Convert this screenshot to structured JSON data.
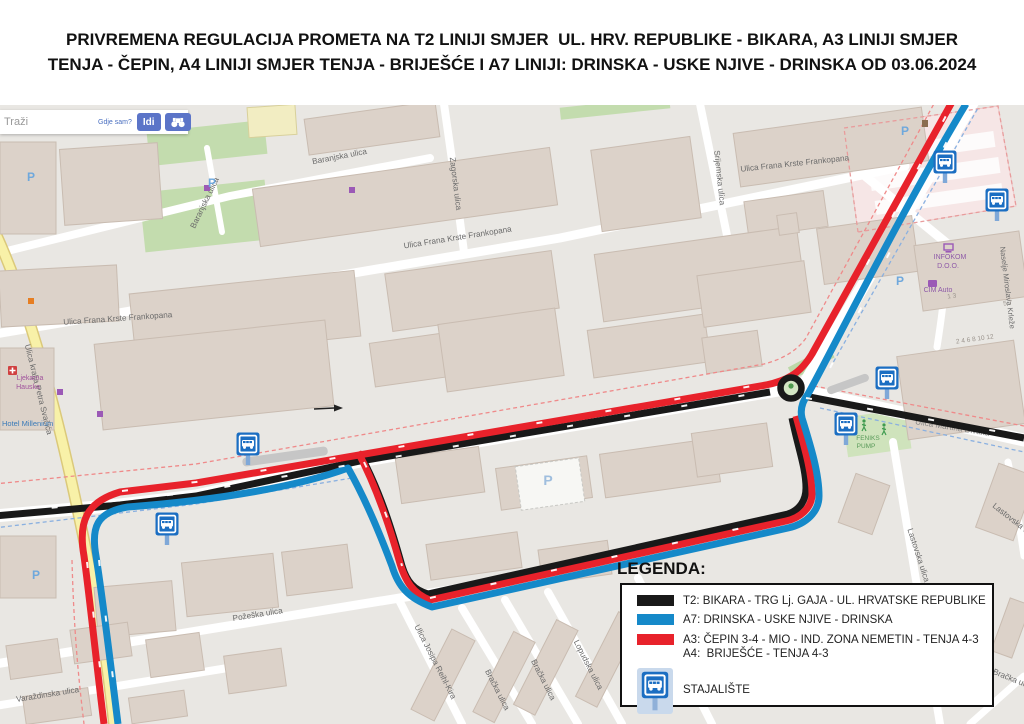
{
  "title": {
    "line1": "PRIVREMENA REGULACIJA PROMETA NA T2 LINIJI SMJER  UL. HRV. REPUBLIKE - BIKARA, A3 LINIJI SMJER",
    "line2": "TENJA - ČEPIN, A4 LINIJI SMJER TENJA - BRIJEŠĆE I A7 LINIJI: DRINSKA - USKE NJIVE - DRINSKA OD 03.06.2024"
  },
  "search": {
    "placeholder": "Traži",
    "where_am_i": "Gdje sam?",
    "go": "Idi"
  },
  "legend": {
    "heading": "LEGENDA:",
    "t2": {
      "color": "#191919",
      "label": "T2: BIKARA - TRG Lj. GAJA - UL. HRVATSKE REPUBLIKE"
    },
    "a7": {
      "color": "#1589c9",
      "label": "A7: DRINSKA - USKE NJIVE - DRINSKA"
    },
    "a3": {
      "color": "#e8222b",
      "label": "A3: ČEPIN 3-4 - MIO - IND. ZONA NEMETIN - TENJA 4-3"
    },
    "a4": {
      "label": "A4:  BRIJEŠĆE - TENJA 4-3"
    },
    "stop_label": "STAJALIŠTE"
  },
  "map": {
    "colors": {
      "route_red": "#e8222b",
      "route_blue": "#1589c9",
      "route_black": "#191919",
      "bus_sign_blue": "#1b6ec2"
    },
    "parking_letter": "P",
    "streets": [
      {
        "t": "Baranjska ulica"
      },
      {
        "t": "Baranjska ulica"
      },
      {
        "t": "Zagorska ulica"
      },
      {
        "t": "Srijemska ulica"
      },
      {
        "t": "Ulica Frana Krste Frankopana"
      },
      {
        "t": "Ulica Frana Krste Frankopana"
      },
      {
        "t": "Ulica Frana Krste Frankopana"
      },
      {
        "t": "Ulica kralja Petra Svačića"
      },
      {
        "t": "Požeška ulica"
      },
      {
        "t": "Varaždinska ulica"
      },
      {
        "t": "Ulica Josipa Reihl-Kira"
      },
      {
        "t": "Bračka ulica"
      },
      {
        "t": "Bračka ulica"
      },
      {
        "t": "Lopudska ulica"
      },
      {
        "t": "Lastovska ulica"
      },
      {
        "t": "Lastovska ulica"
      },
      {
        "t": "Bračka ulica"
      },
      {
        "t": "Ulica Martina Divalta"
      },
      {
        "t": "Naselje Miroslava Krleže"
      }
    ],
    "pois": [
      {
        "t": "INFOKOM"
      },
      {
        "t": "D.O.O."
      },
      {
        "t": "CIM Auto"
      },
      {
        "t": "Ljekarna"
      },
      {
        "t": "Hauska"
      },
      {
        "t": "Hotel Millenium"
      },
      {
        "t": "FENIKS"
      },
      {
        "t": "PUMP"
      }
    ],
    "house_numbers": [
      {
        "t": "2 4   6 8   10 12"
      },
      {
        "t": "1 3"
      },
      {
        "t": "5 7"
      }
    ]
  }
}
